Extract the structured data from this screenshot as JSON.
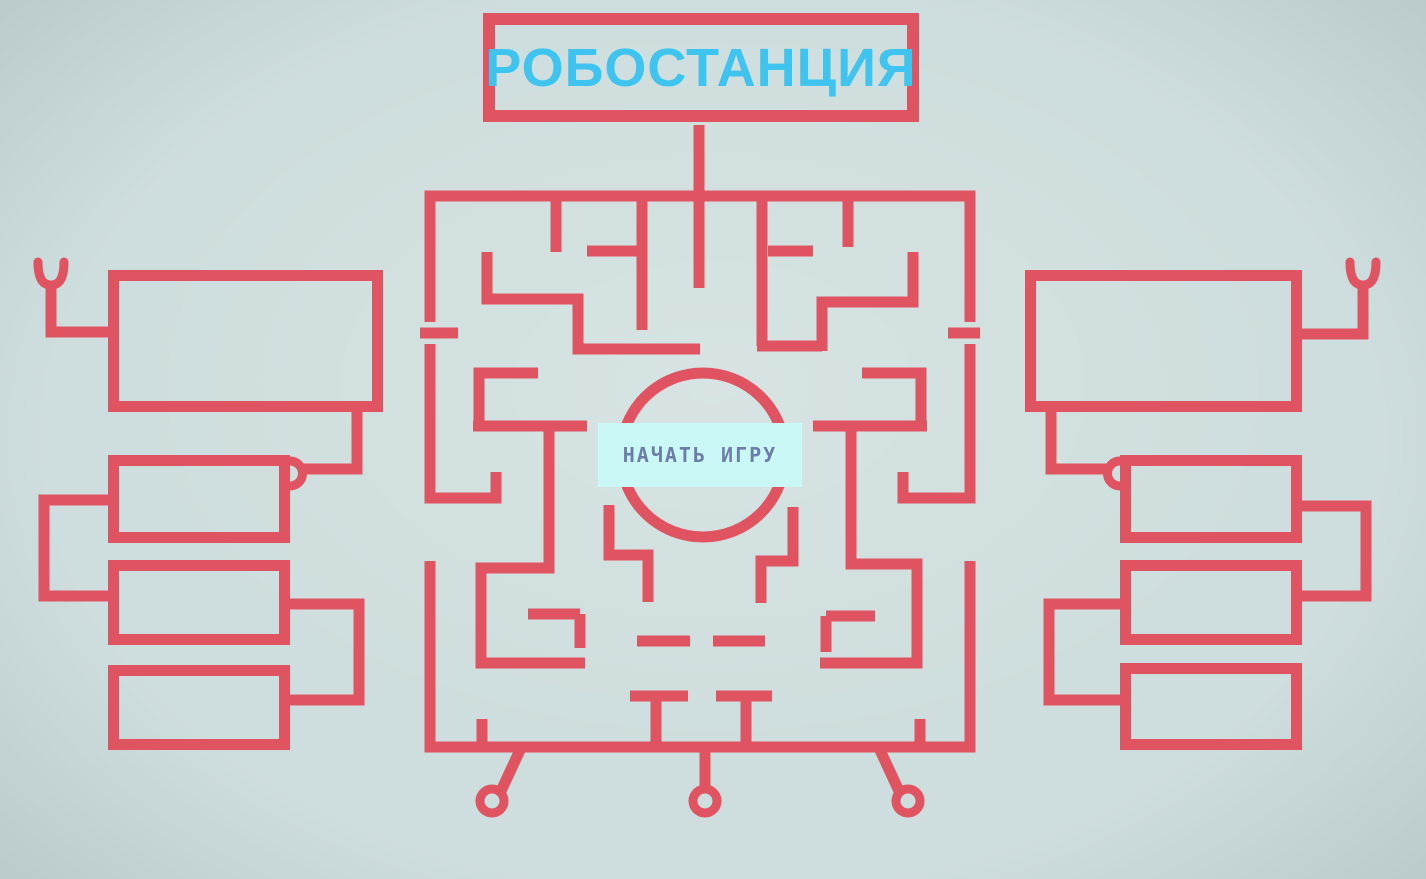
{
  "title": "РОБОСТАНЦИЯ",
  "start_button_label": "НАЧАТЬ ИГРУ",
  "colors": {
    "red": "#e05361",
    "cyan": "#3ec4ef",
    "background": "#cedddd",
    "button_bg": "#c9f8f6",
    "button_text": "#6d7ea6"
  }
}
